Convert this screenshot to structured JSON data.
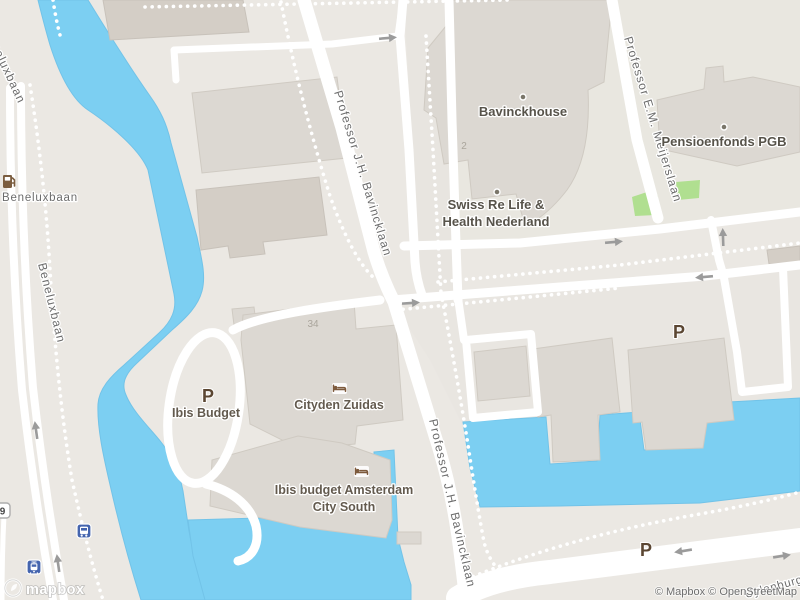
{
  "map": {
    "street_labels": {
      "beneluxbaan_corner": "Beneluxbaan",
      "beneluxbaan_h": "Beneluxbaan",
      "beneluxbaan_v": "Beneluxbaan",
      "bavincklaan_top": "Professor J.H. Bavincklaan",
      "bavincklaan_bottom": "Professor J.H. Bavincklaan",
      "meijerslaan": "Professor E.M. Meijerslaan",
      "uylenburgweg": "Uylenburgweg"
    },
    "poi_labels": {
      "bavinckhouse": "Bavinckhouse",
      "swiss_re_line1": "Swiss Re Life &",
      "swiss_re_line2": "Health Nederland",
      "pensioenfonds": "Pensioenfonds PGB",
      "cityden": "Cityden Zuidas",
      "ibis_budget": "Ibis Budget",
      "ibis_city_south_line1": "Ibis budget Amsterdam",
      "ibis_city_south_line2": "City South",
      "house_number_34": "34",
      "house_number_2": "2"
    },
    "symbols": {
      "parking": "P",
      "route_shield": "9"
    },
    "icons": [
      "fuel-station-icon",
      "bed-icon",
      "bus-stop-icon",
      "tram-stop-icon",
      "one-way-arrow",
      "poi-dot"
    ],
    "branding": {
      "logo_text": "mapbox",
      "attribution": "© Mapbox © OpenStreetMap"
    },
    "colors": {
      "water": "#7ccff2",
      "land": "#ebe8e3",
      "building": "#dcd8d2",
      "green_area": "#b0df90",
      "road": "#ffffff",
      "transit_blue": "#4464ae",
      "poi_brown": "#5b4632",
      "hotel_icon_brown": "#7d5a3c",
      "street_label_gray": "#6c6c6c"
    }
  }
}
